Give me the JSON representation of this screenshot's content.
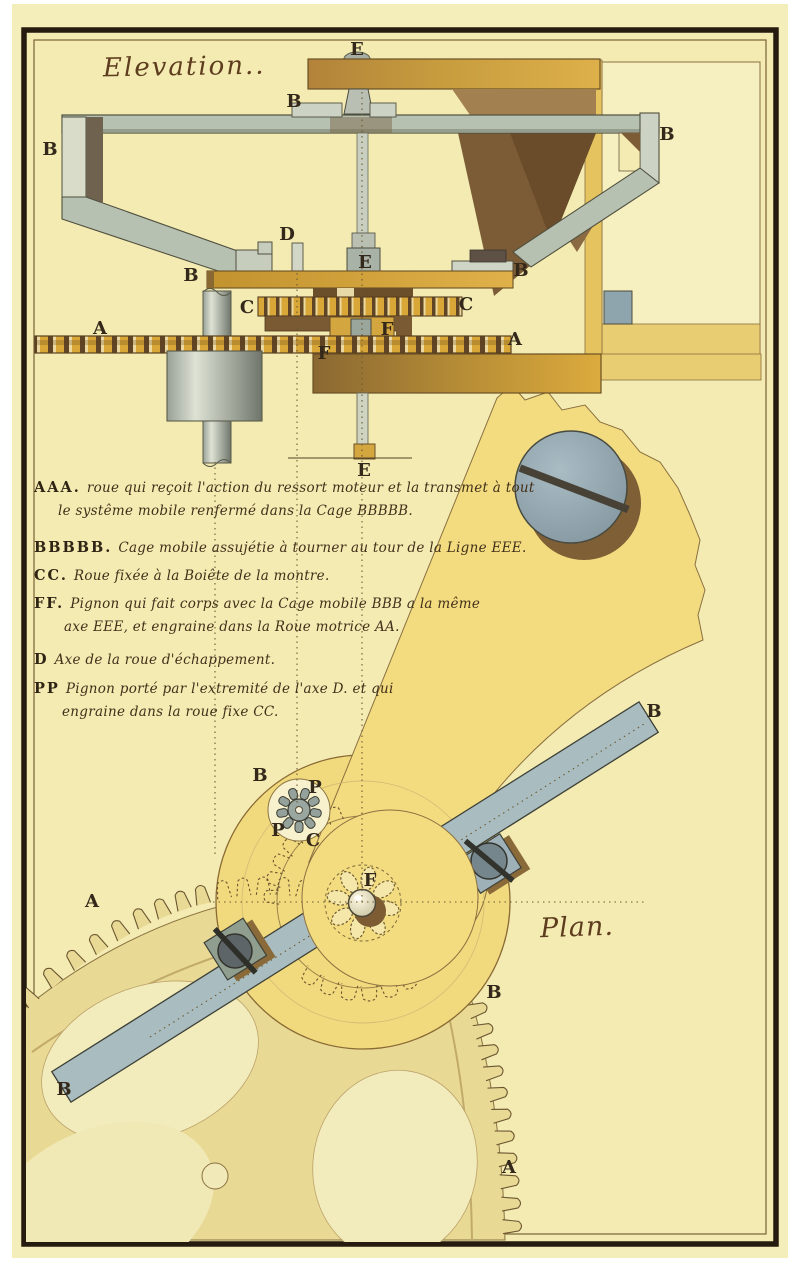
{
  "titles": {
    "elevation": "Elevation..",
    "plan": "Plan."
  },
  "legend": {
    "entries": [
      {
        "key": "AAA.",
        "lines": [
          "roue qui reçoit l'action du ressort moteur et la transmet à tout",
          "le systême mobile renfermé dans la Cage BBBBB."
        ]
      },
      {
        "key": "BBBBB.",
        "lines": [
          "Cage mobile assujétie à tourner au tour de la Ligne EEE."
        ]
      },
      {
        "key": "CC.",
        "lines": [
          "Roue fixée à la Boiête de la montre."
        ]
      },
      {
        "key": "FF.",
        "lines": [
          "Pignon qui fait corps avec la Cage mobile BBB a la même",
          "axe EEE, et engraine dans la Roue motrice AA."
        ]
      },
      {
        "key": "D",
        "lines": [
          "Axe de la roue d'échappement."
        ]
      },
      {
        "key": "PP",
        "lines": [
          "Pignon porté par l'extremité de l'axe D. et qui",
          "engraine dans la roue fixe CC."
        ]
      }
    ]
  },
  "labels": {
    "elevation": [
      "E",
      "B",
      "B",
      "B",
      "D",
      "E",
      "B",
      "B",
      "C",
      "C",
      "A",
      "A",
      "F",
      "F",
      "E"
    ],
    "plan": [
      "B",
      "P",
      "P",
      "C",
      "F",
      "B",
      "A",
      "B",
      "B",
      "A"
    ]
  },
  "palette": {
    "paper": "#f3ebb2",
    "paperMargin": "#f4eeba",
    "frame": "#261b0f",
    "innerRule": "#7a6234",
    "steel": "#b7c1b2",
    "steelPale": "#ccd3c4",
    "steelDark": "#6f6350",
    "brass": "#d8a738",
    "brassDeep": "#8a6832",
    "brassPale": "#e9cd72",
    "brown": "#7b5c36",
    "inkLine": "#6b5530",
    "ink": "#42301a",
    "blueGrey": "#93a7b2",
    "cageYellow": "#f1da7e",
    "fanYellow": "#f3dc80",
    "gearBody": "#e8d995",
    "gearPale": "#f2ecbc",
    "barSteel": "#a9bcbf"
  }
}
